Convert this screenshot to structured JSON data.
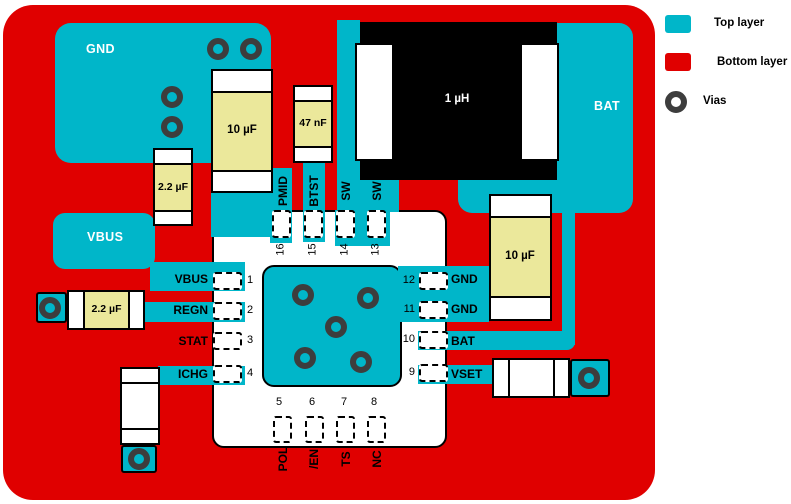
{
  "legend": {
    "top_layer_label": "Top layer",
    "bottom_layer_label": "Bottom layer",
    "vias_label": "Vias"
  },
  "colors": {
    "top_layer": "#00b6c9",
    "bottom_layer": "#e00000",
    "component_body": "#ebe89b",
    "via_ring": "#3d3d3d",
    "inductor_body": "#000000"
  },
  "net_labels": {
    "gnd_region": "GND",
    "vbus_region": "VBUS",
    "bat_region": "BAT"
  },
  "components": {
    "cap_vbus_small": "2.2 µF",
    "cap_pmid": "10 µF",
    "cap_btst": "47 nF",
    "inductor": "1 µH",
    "cap_bat": "10 µF",
    "cap_regn": "2.2 µF"
  },
  "ic": {
    "left_pins": [
      {
        "num": "1",
        "label": "VBUS"
      },
      {
        "num": "2",
        "label": "REGN"
      },
      {
        "num": "3",
        "label": "STAT"
      },
      {
        "num": "4",
        "label": "ICHG"
      }
    ],
    "right_pins": [
      {
        "num": "12",
        "label": "GND"
      },
      {
        "num": "11",
        "label": "GND"
      },
      {
        "num": "10",
        "label": "BAT"
      },
      {
        "num": "9",
        "label": "VSET"
      }
    ],
    "top_pins": [
      {
        "num": "16",
        "label": "PMID"
      },
      {
        "num": "15",
        "label": "BTST"
      },
      {
        "num": "14",
        "label": "SW"
      },
      {
        "num": "13",
        "label": "SW"
      }
    ],
    "bottom_pins": [
      {
        "num": "5",
        "label": "POL"
      },
      {
        "num": "6",
        "label": "/EN"
      },
      {
        "num": "7",
        "label": "TS"
      },
      {
        "num": "8",
        "label": "NC"
      }
    ]
  }
}
